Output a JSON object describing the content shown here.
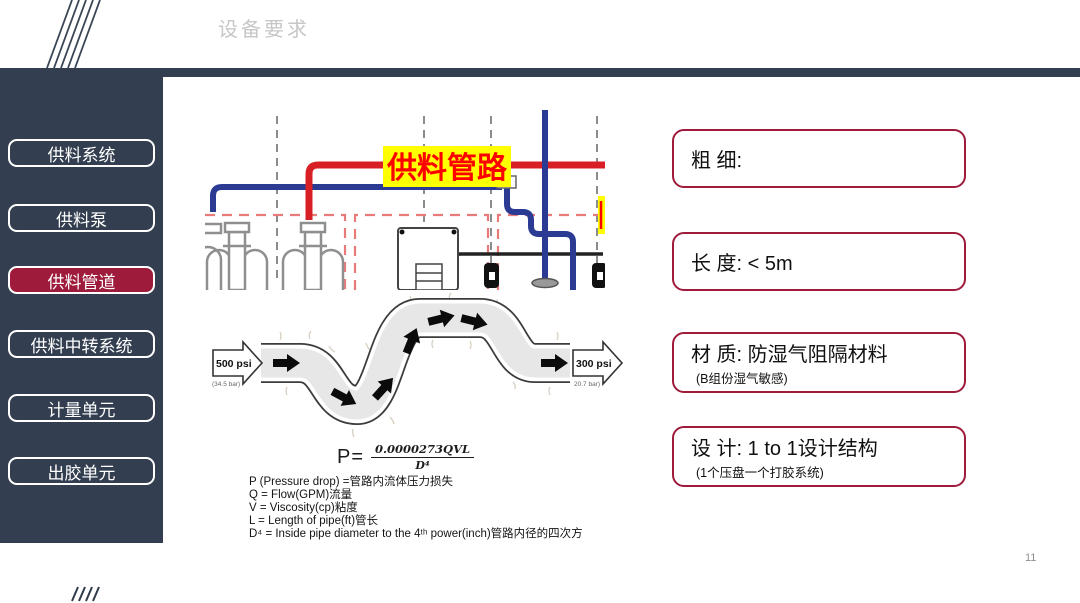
{
  "slide": {
    "title": "设备要求",
    "page_number": "11"
  },
  "colors": {
    "navy": "#333F50",
    "maroon": "#9E1B3C",
    "pipe_red": "#D81F26",
    "pipe_blue": "#2B3A92",
    "highlight_yellow": "#FFFF00",
    "highlight_text_red": "#FF0000",
    "title_gray": "#C7C7C7"
  },
  "sidebar": {
    "items": [
      {
        "label": "供料系统",
        "active": false
      },
      {
        "label": "供料泵",
        "active": false
      },
      {
        "label": "供料管道",
        "active": true
      },
      {
        "label": "供料中转系统",
        "active": false
      },
      {
        "label": "计量单元",
        "active": false
      },
      {
        "label": "出胶单元",
        "active": false
      }
    ]
  },
  "piping_diagram": {
    "pipe_label": "供料管路"
  },
  "pressure_diagram": {
    "inlet_pressure": "500 psi",
    "inlet_bar": "(34.5 bar)",
    "outlet_pressure": "300 psi",
    "outlet_bar": "20.7 bar)"
  },
  "formula": {
    "lhs": "P=",
    "numerator": "0.0000273QVL",
    "denominator": "D⁴",
    "legend": [
      "P (Pressure drop) =管路内流体压力损失",
      "Q = Flow(GPM)流量",
      "V = Viscosity(cp)粘度",
      "L = Length of pipe(ft)管长",
      "D⁴ = Inside pipe diameter to the 4ᵗʰ power(inch)管路内径的四次方"
    ]
  },
  "spec_boxes": [
    {
      "label": "粗 细:",
      "sub": ""
    },
    {
      "label": "长 度:  < 5m",
      "sub": ""
    },
    {
      "label": "材 质: 防湿气阻隔材料",
      "sub": "(B组份湿气敏感)"
    },
    {
      "label": "设 计: 1 to 1设计结构",
      "sub": "(1个压盘一个打胶系统)"
    }
  ]
}
